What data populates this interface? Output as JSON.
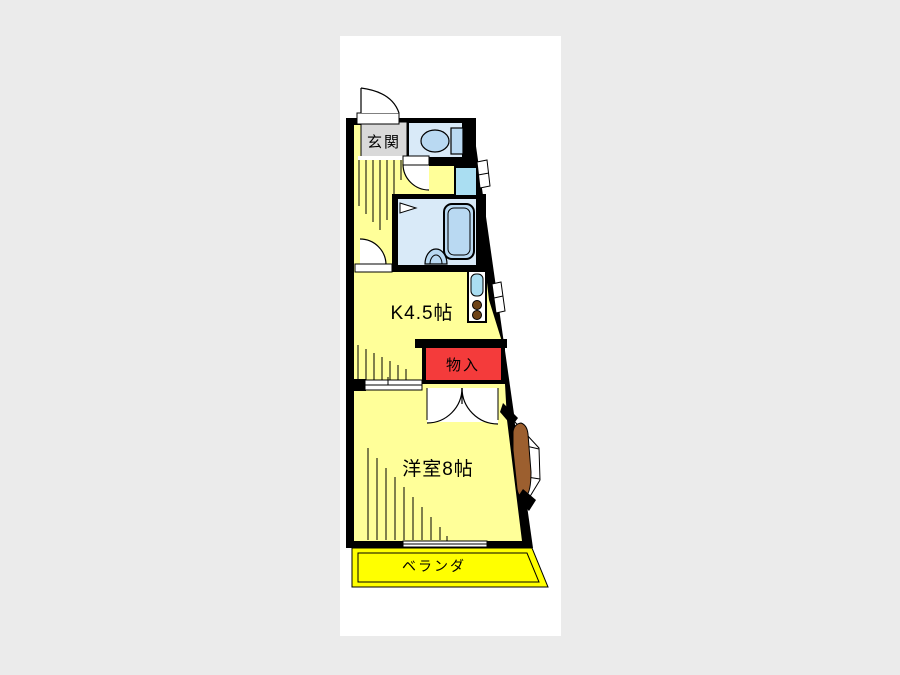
{
  "canvas": {
    "page_bg": "#ebebeb",
    "canvas_bg": "#ffffff"
  },
  "palette": {
    "wall": "#000000",
    "room_yellow": "#ffff99",
    "veranda_yellow": "#ffff00",
    "water_room": "#d9eaf8",
    "fixture_blue": "#b9d9f2",
    "appliance_blue": "#aadef2",
    "storage_red": "#f43b3b",
    "genkan_gray": "#d9d9d9",
    "door_brown": "#9c5f2f",
    "burner_brown": "#6e4418",
    "line": "#000000"
  },
  "labels": {
    "genkan": "玄関",
    "kitchen": "K4.5帖",
    "storage": "物入",
    "western_room": "洋室8帖",
    "veranda": "ベランダ"
  }
}
